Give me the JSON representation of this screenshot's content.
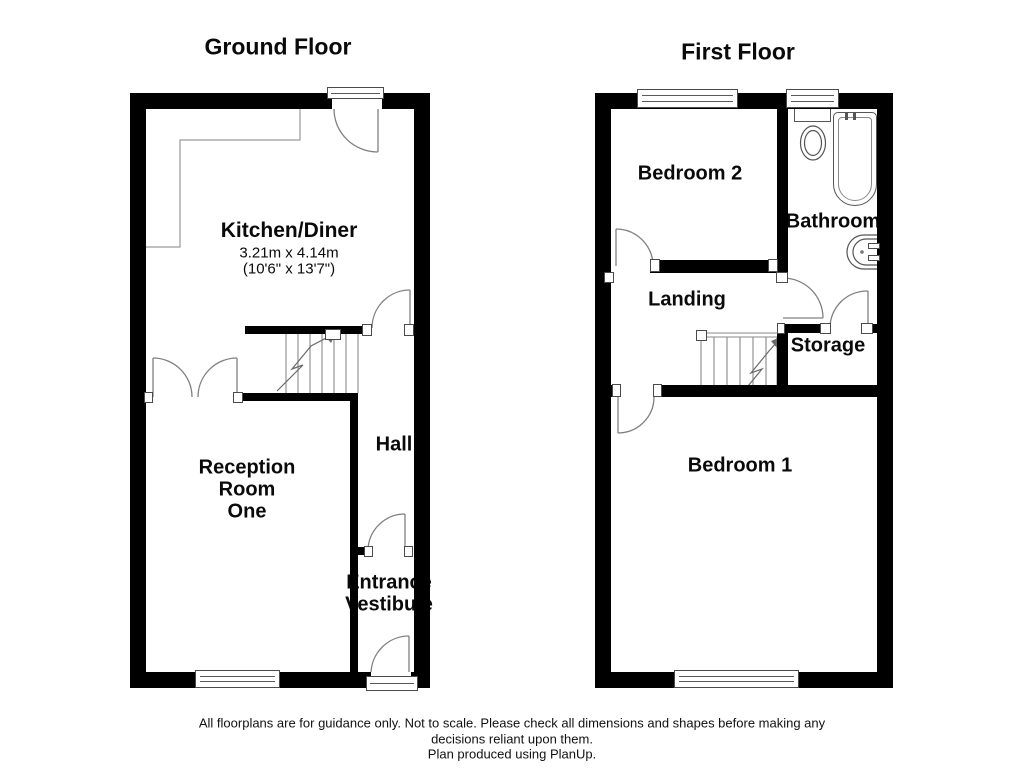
{
  "ground_floor": {
    "title": "Ground Floor",
    "rooms": {
      "kitchen": {
        "name": "Kitchen/Diner",
        "dimensions_metric": "3.21m x 4.14m",
        "dimensions_imperial": "(10'6\" x 13'7\")"
      },
      "hall": "Hall",
      "reception_line1": "Reception",
      "reception_line2": "Room",
      "reception_line3": "One",
      "vestibule_line1": "Entrance",
      "vestibule_line2": "Vestibule"
    }
  },
  "first_floor": {
    "title": "First Floor",
    "rooms": {
      "bedroom2": "Bedroom 2",
      "bathroom": "Bathroom",
      "landing": "Landing",
      "storage": "Storage",
      "bedroom1": "Bedroom 1"
    }
  },
  "footer": {
    "line1": "All floorplans are for guidance only. Not to scale. Please check all dimensions and shapes before making any",
    "line2": "decisions reliant upon them.",
    "line3": "Plan produced using PlanUp."
  },
  "colors": {
    "wall": "#000000",
    "door_line": "#808080",
    "fixture_line": "#555555",
    "text": "#0a0a0a"
  }
}
